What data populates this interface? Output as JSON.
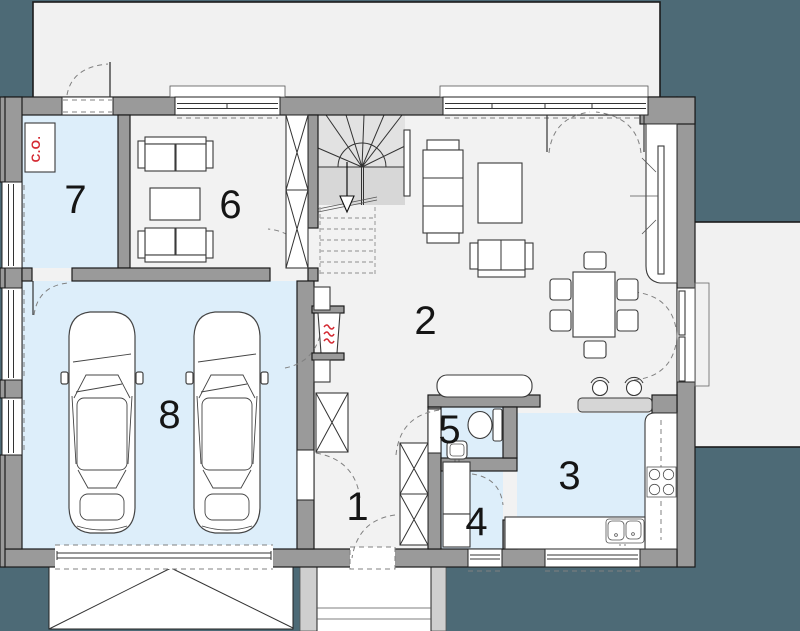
{
  "plan": {
    "room_labels": {
      "hall": "1",
      "living_room": "2",
      "kitchen": "3",
      "utility": "4",
      "wc": "5",
      "study": "6",
      "boiler_room": "7",
      "garage": "8"
    },
    "boiler_tag": "C.O.",
    "colors": {
      "outside": "#4d6a76",
      "floor": "#f2f2f2",
      "wet_room": "#ddeefa",
      "wall": "#9a9a9a",
      "paving": "#f1f1f1",
      "accent_red": "#d42a33"
    }
  }
}
